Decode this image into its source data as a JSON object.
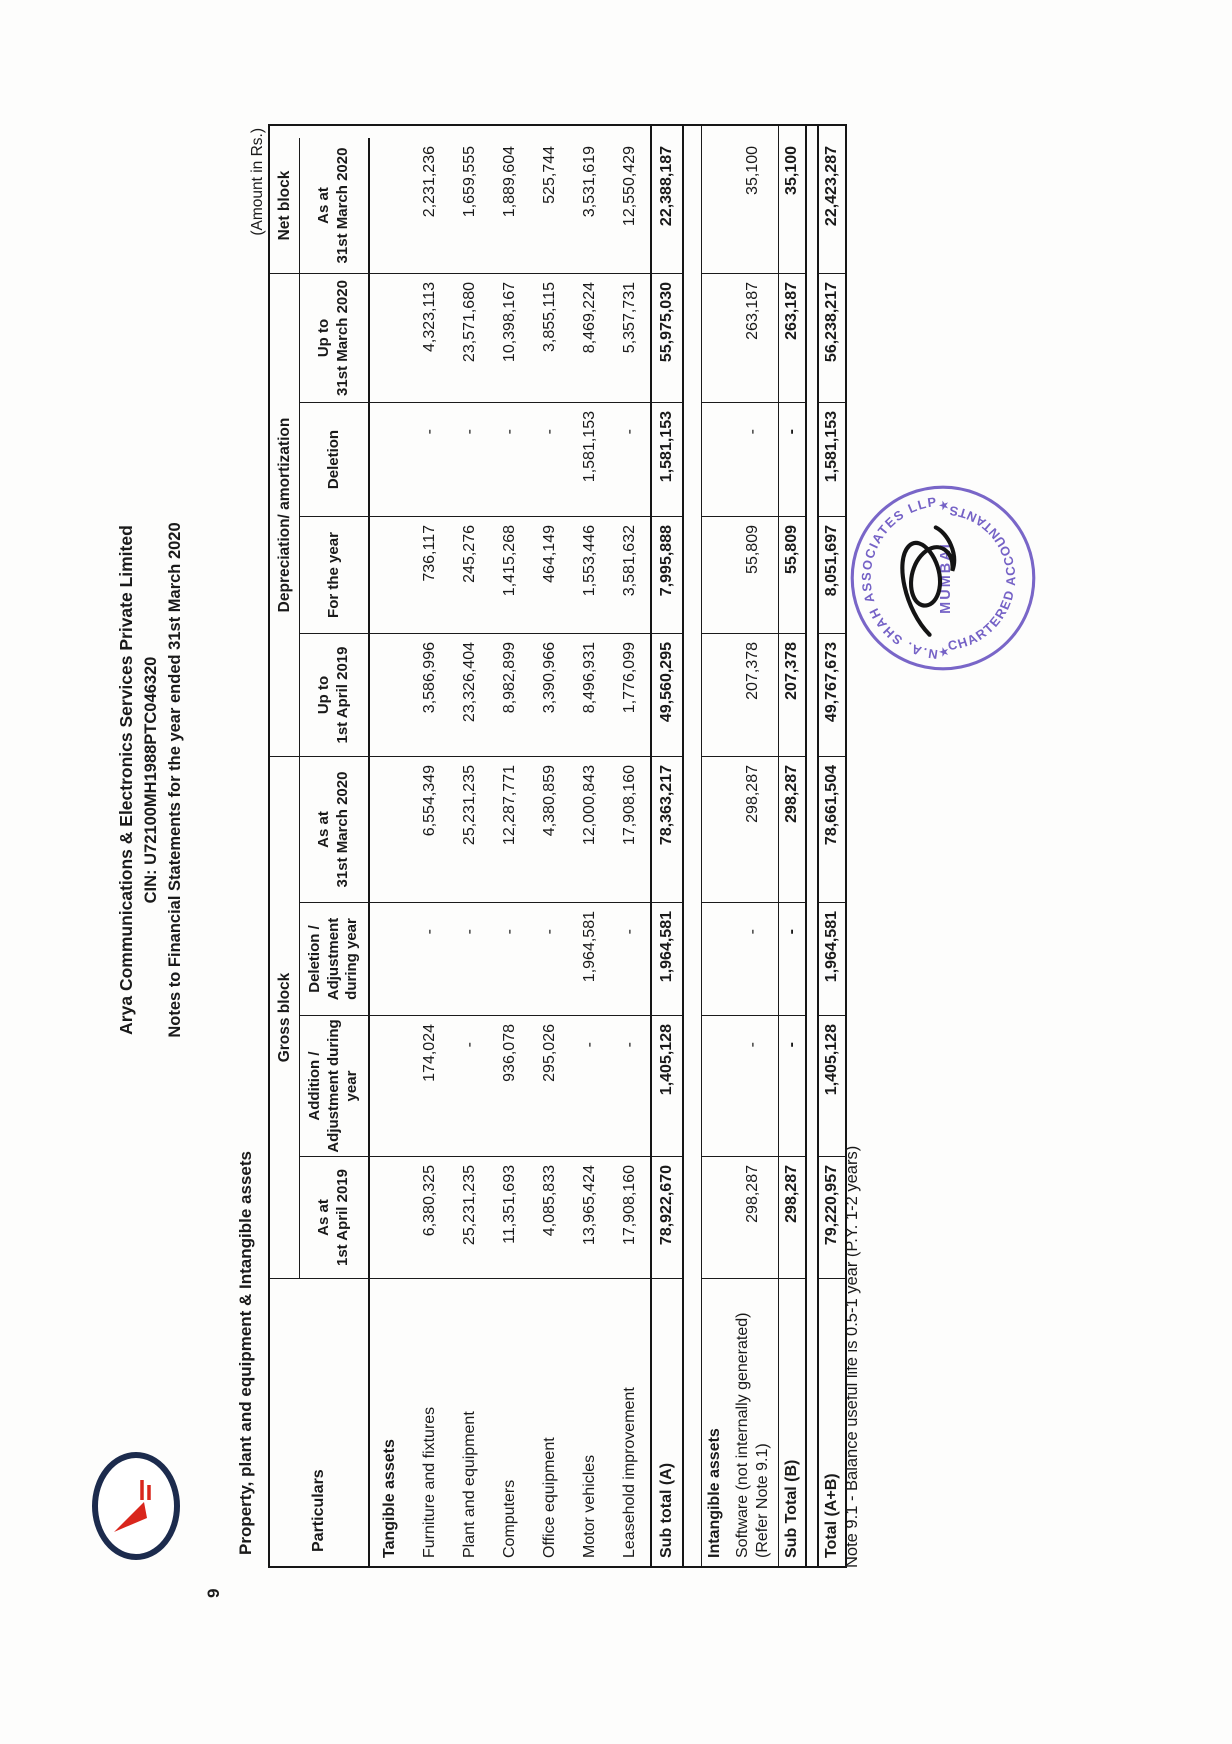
{
  "page": {
    "amount_note": "(Amount in Rs.)",
    "section_number": "9",
    "section_title": "Property, plant and equipment & Intangible assets",
    "footnote": "Note 9.1 - Balance useful life is 0.5-1 year (P.Y. 1-2 years)"
  },
  "letterhead": {
    "company": "Arya Communications & Electronics Services Private Limited",
    "cin": "CIN: U72100MH1988PTC046320",
    "subtitle": "Notes to Financial Statements for the year ended 31st March 2020"
  },
  "table": {
    "particulars_label": "Particulars",
    "groups": [
      {
        "label": "Gross block",
        "span": 4
      },
      {
        "label": "Depreciation/ amortization",
        "span": 4
      },
      {
        "label": "Net block",
        "span": 1
      }
    ],
    "columns": [
      "As at\n1st April 2019",
      "Addition /\nAdjustment during\nyear",
      "Deletion /\nAdjustment\nduring year",
      "As at\n31st March 2020",
      "Up to\n1st April 2019",
      "For the year",
      "Deletion",
      "Up to\n31st March 2020",
      "As at\n31st March 2020"
    ],
    "rows": [
      {
        "type": "section",
        "label": "Tangible assets",
        "values": [
          "",
          "",
          "",
          "",
          "",
          "",
          "",
          "",
          ""
        ]
      },
      {
        "type": "data",
        "label": "Furniture and fixtures",
        "values": [
          "6,380,325",
          "174,024",
          "-",
          "6,554,349",
          "3,586,996",
          "736,117",
          "-",
          "4,323,113",
          "2,231,236"
        ]
      },
      {
        "type": "data",
        "label": "Plant and equipment",
        "values": [
          "25,231,235",
          "-",
          "-",
          "25,231,235",
          "23,326,404",
          "245,276",
          "-",
          "23,571,680",
          "1,659,555"
        ]
      },
      {
        "type": "data",
        "label": "Computers",
        "values": [
          "11,351,693",
          "936,078",
          "-",
          "12,287,771",
          "8,982,899",
          "1,415,268",
          "-",
          "10,398,167",
          "1,889,604"
        ]
      },
      {
        "type": "data",
        "label": "Office equipment",
        "values": [
          "4,085,833",
          "295,026",
          "-",
          "4,380,859",
          "3,390,966",
          "464,149",
          "-",
          "3,855,115",
          "525,744"
        ]
      },
      {
        "type": "data",
        "label": "Motor vehicles",
        "values": [
          "13,965,424",
          "-",
          "1,964,581",
          "12,000,843",
          "8,496,931",
          "1,553,446",
          "1,581,153",
          "8,469,224",
          "3,531,619"
        ]
      },
      {
        "type": "data",
        "label": "Leasehold improvement",
        "values": [
          "17,908,160",
          "-",
          "-",
          "17,908,160",
          "1,776,099",
          "3,581,632",
          "-",
          "5,357,731",
          "12,550,429"
        ]
      },
      {
        "type": "subtotal",
        "label": "Sub total (A)",
        "values": [
          "78,922,670",
          "1,405,128",
          "1,964,581",
          "78,363,217",
          "49,560,295",
          "7,995,888",
          "1,581,153",
          "55,975,030",
          "22,388,187"
        ]
      },
      {
        "type": "gap"
      },
      {
        "type": "block-head",
        "label": "Intangible assets",
        "values": [
          "",
          "",
          "",
          "",
          "",
          "",
          "",
          "",
          ""
        ]
      },
      {
        "type": "block-data",
        "label": "Software (not internally generated)\n(Refer Note 9.1)",
        "values": [
          "298,287",
          "-",
          "-",
          "298,287",
          "207,378",
          "55,809",
          "-",
          "263,187",
          "35,100"
        ]
      },
      {
        "type": "subtotal2",
        "label": "Sub Total (B)",
        "values": [
          "298,287",
          "-",
          "-",
          "298,287",
          "207,378",
          "55,809",
          "-",
          "263,187",
          "35,100"
        ]
      },
      {
        "type": "gap-sm"
      },
      {
        "type": "total",
        "label": "Total (A+B)",
        "values": [
          "79,220,957",
          "1,405,128",
          "1,964,581",
          "78,661,504",
          "49,767,673",
          "8,051,697",
          "1,581,153",
          "56,238,217",
          "22,423,287"
        ]
      }
    ]
  },
  "stamp": {
    "arc_top": "N.A. SHAH ASSOCIATES LLP",
    "arc_bottom": "CHARTERED ACCOUNTANTS",
    "center": "MUMBAI",
    "star": "★",
    "color": "#6a55c2"
  },
  "colors": {
    "ink": "#1a1a1a",
    "stamp": "#6a55c2",
    "logo_ring": "#1c2b4d",
    "logo_accent": "#d9261c"
  }
}
